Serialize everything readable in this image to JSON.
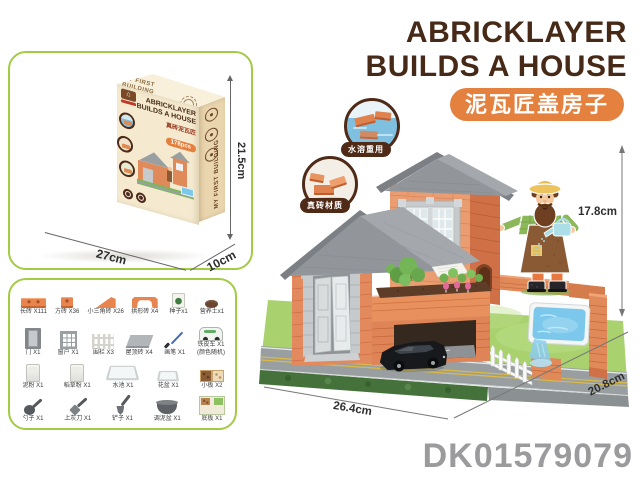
{
  "header": {
    "title_line1": "ABRICKLAYER",
    "title_line2": "BUILDS A HOUSE",
    "subtitle": "泥瓦匠盖房子"
  },
  "box_panel": {
    "dims": {
      "height": "21.5cm",
      "width": "27cm",
      "depth": "10cm"
    },
    "box": {
      "title1": "ABRICKLAYER",
      "title2": "BUILDS A HOUSE",
      "cn": "真砖泥瓦匠",
      "pcs": "178pcs",
      "logo_glyph": "⌂",
      "side_text": "MY FIRST BUILDING",
      "top_text": "MY FIRST BUILDING"
    }
  },
  "callouts": [
    {
      "label": "水溶重用"
    },
    {
      "label": "真砖材质"
    }
  ],
  "parts": {
    "rows": [
      {
        "items": [
          {
            "name": "长砖 X111"
          },
          {
            "name": "方砖 X36"
          },
          {
            "name": "小三角砖 X26"
          },
          {
            "name": "拱形砖 X4"
          },
          {
            "name": "种子x1"
          },
          {
            "name": "营养土x1"
          }
        ]
      },
      {
        "items": [
          {
            "name": "门 X1"
          },
          {
            "name": "窗户 X1"
          },
          {
            "name": "围栏 X3"
          },
          {
            "name": "屋顶砖 X4"
          },
          {
            "name": "画笔 X1"
          },
          {
            "name": "铁皮车 X1",
            "sub": "(颜色随机)"
          }
        ]
      },
      {
        "items": [
          {
            "name": "泥粉 X1"
          },
          {
            "name": "稻草粉 X1"
          },
          {
            "name": "水池 X1"
          },
          {
            "name": "花盆 X1"
          },
          {
            "name": "小板 X2"
          }
        ]
      },
      {
        "items": [
          {
            "name": "勺子 X1"
          },
          {
            "name": "上灰刀 X1"
          },
          {
            "name": "铲子 X1"
          },
          {
            "name": "调泥盆 X1"
          },
          {
            "name": "底板 X1"
          }
        ]
      }
    ]
  },
  "scene": {
    "dims": {
      "height": "17.8cm",
      "width": "26.4cm",
      "depth": "20.8cm"
    }
  },
  "product_code": "DK01579079",
  "colors": {
    "accent_orange": "#e5813f",
    "title_brown": "#462916",
    "panel_green": "#a3cb43",
    "brick_orange": "#e08a5a",
    "roof_gray": "#92969a",
    "code_gray": "#9b9b9d"
  }
}
